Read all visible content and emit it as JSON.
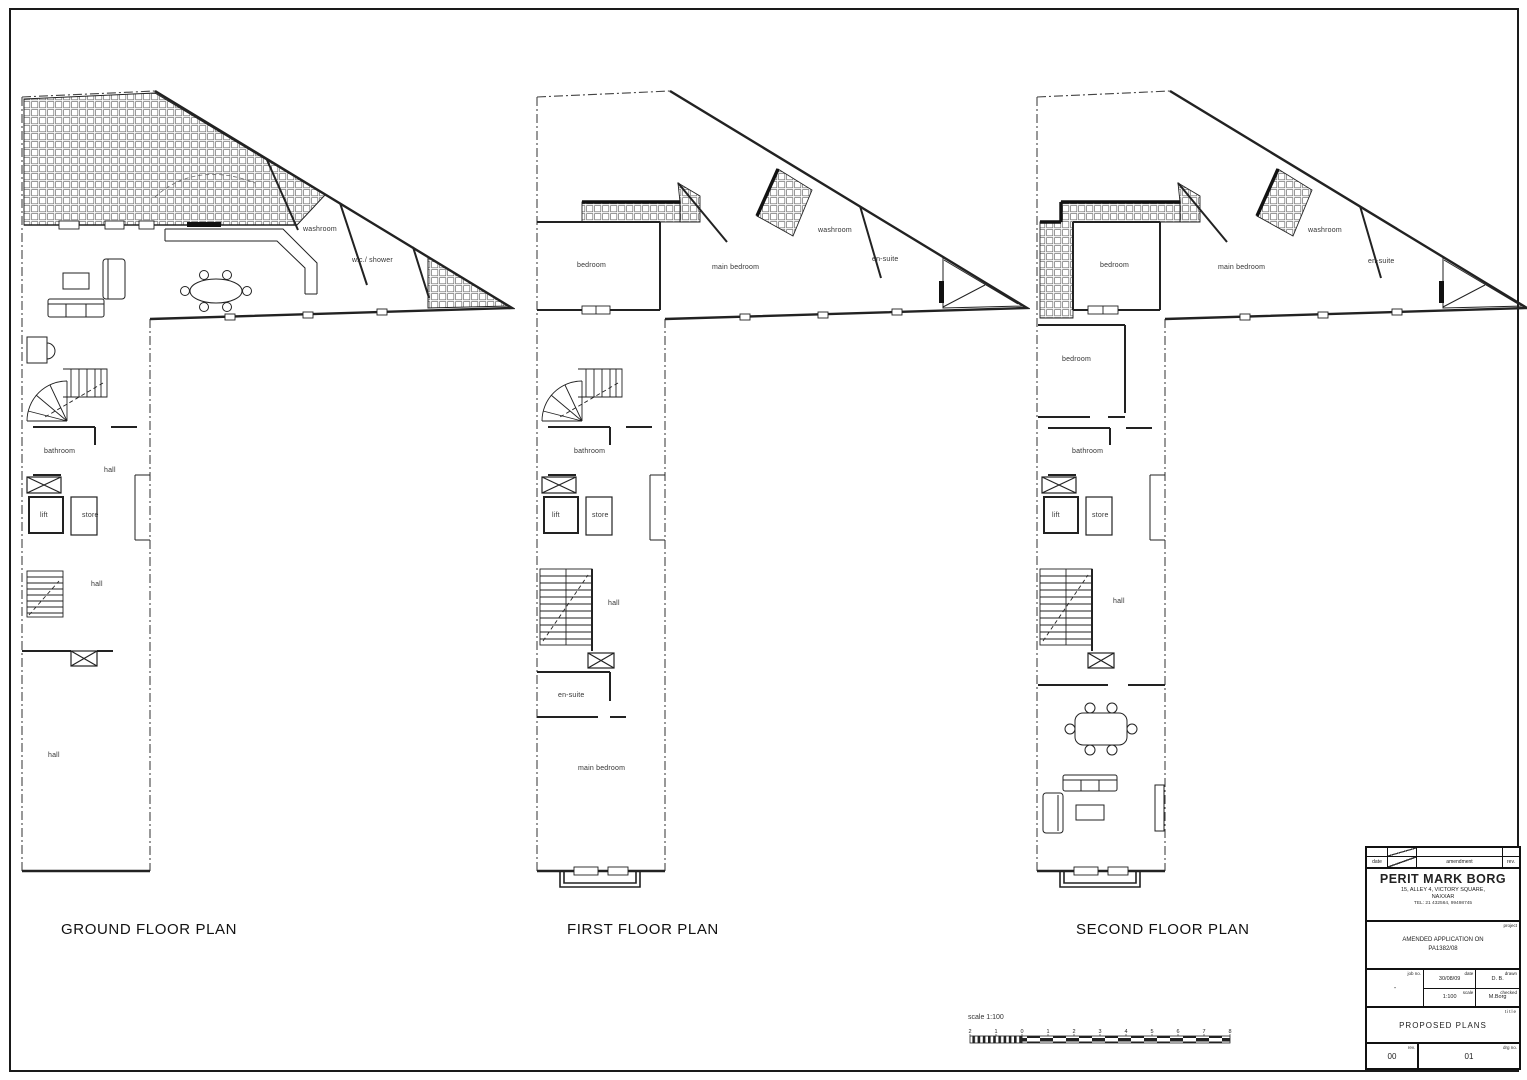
{
  "plans": [
    {
      "title": "GROUND FLOOR PLAN",
      "labels": {
        "washroom": "washroom",
        "wc_shower": "w.c./ shower",
        "bathroom": "bathroom",
        "hall_upper": "hall",
        "lift": "lift",
        "store": "store",
        "hall_mid": "hall",
        "hall_lower": "hall"
      }
    },
    {
      "title": "FIRST FLOOR PLAN",
      "labels": {
        "bedroom": "bedroom",
        "main_bedroom": "main bedroom",
        "washroom": "washroom",
        "ensuite": "en-suite",
        "bathroom": "bathroom",
        "lift": "lift",
        "store": "store",
        "hall": "hall",
        "ensuite_lower": "en-suite",
        "main_bedroom_lower": "main bedroom"
      }
    },
    {
      "title": "SECOND FLOOR PLAN",
      "labels": {
        "bedroom": "bedroom",
        "main_bedroom": "main bedroom",
        "washroom": "washroom",
        "ensuite": "en-suite",
        "bedroom2": "bedroom",
        "bathroom": "bathroom",
        "lift": "lift",
        "store": "store",
        "hall": "hall"
      }
    }
  ],
  "scale_bar": {
    "label": "scale 1:100",
    "numbers": [
      "2",
      "1",
      "0",
      "1",
      "2",
      "3",
      "4",
      "5",
      "6",
      "7",
      "8"
    ]
  },
  "titleblock": {
    "header": {
      "date": "date",
      "amendment": "amendment",
      "rev": "rev."
    },
    "architect": {
      "name": "PERIT MARK BORG",
      "address1": "15, ALLEY 4, VICTORY SQUARE,",
      "address2": "NAXXAR",
      "tel": "TEL: 21 432564, 99498745"
    },
    "project": {
      "label": "project",
      "line1": "AMENDED APPLICATION ON",
      "line2": "PA1382/08"
    },
    "fields": {
      "job_no_label": "job no.",
      "job_no": "-",
      "date_label": "date",
      "date": "30/08/09",
      "drawn_label": "drawn",
      "drawn": "D. B.",
      "scale_label": "scale",
      "scale": "1:100",
      "checked_label": "checked",
      "checked": "M.Borg"
    },
    "title": {
      "label": "title",
      "value": "PROPOSED PLANS"
    },
    "footer": {
      "rev_label": "rev.",
      "rev": "00",
      "drg_label": "drg no.",
      "drg": "01"
    }
  }
}
